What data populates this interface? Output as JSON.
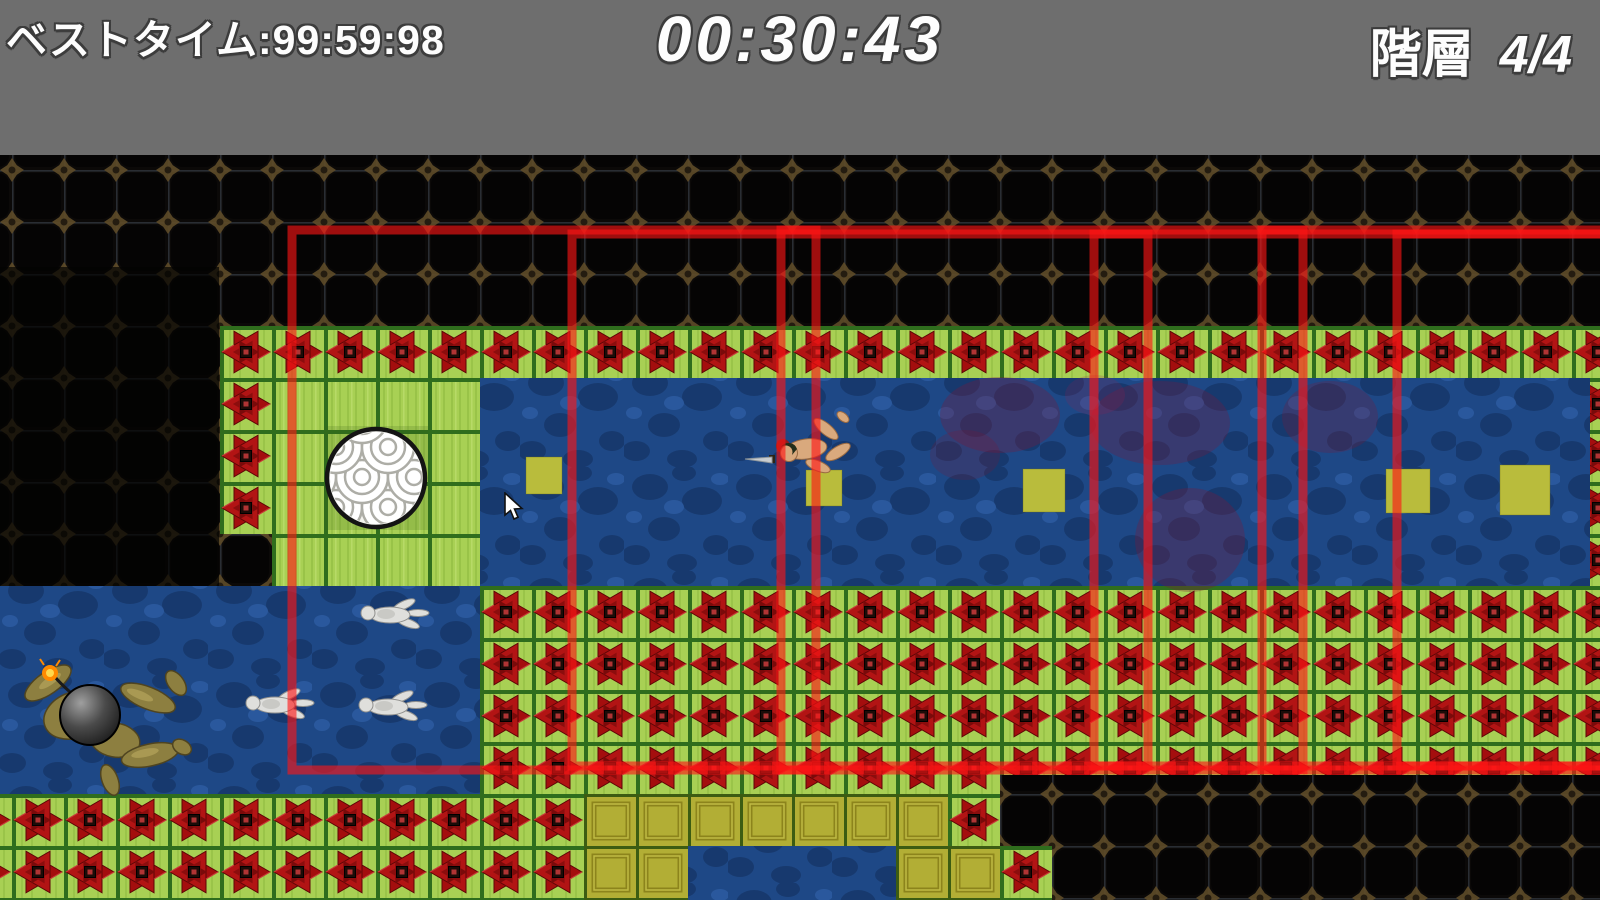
{
  "hud": {
    "best_time": "ベストタイム:99:59:98",
    "timer": "00:30:43",
    "floor_label": "階層",
    "floor_value": "4/4"
  },
  "game": {
    "level": {
      "floor_current": 4,
      "floor_total": 4,
      "item_squares_count": 5,
      "white_swimmers_count": 3
    },
    "entities": {
      "player": "swimmer-with-sword",
      "enemy": "bomb-carrier-ninja",
      "collectible": "yellow-item-square",
      "goal_marker": "seigaiha-wave-ball",
      "hazard_tile": "red-shuriken-tile"
    },
    "colors": {
      "header_bg": "#6e6e6e",
      "hud_text": "#fdfdfd",
      "water_blue": "#1e4886",
      "grass_green": "#a8d054",
      "grid_green": "#2f6d1d",
      "shuriken_red": "#a40e0e",
      "overlay_red": "#ff1515",
      "item_yellow": "#b9bc3c",
      "dark_tile": "#0a0807",
      "dark_tile_accent": "#5e4b27",
      "bomb_black": "#141414",
      "flame_orange": "#ff8a00"
    }
  }
}
